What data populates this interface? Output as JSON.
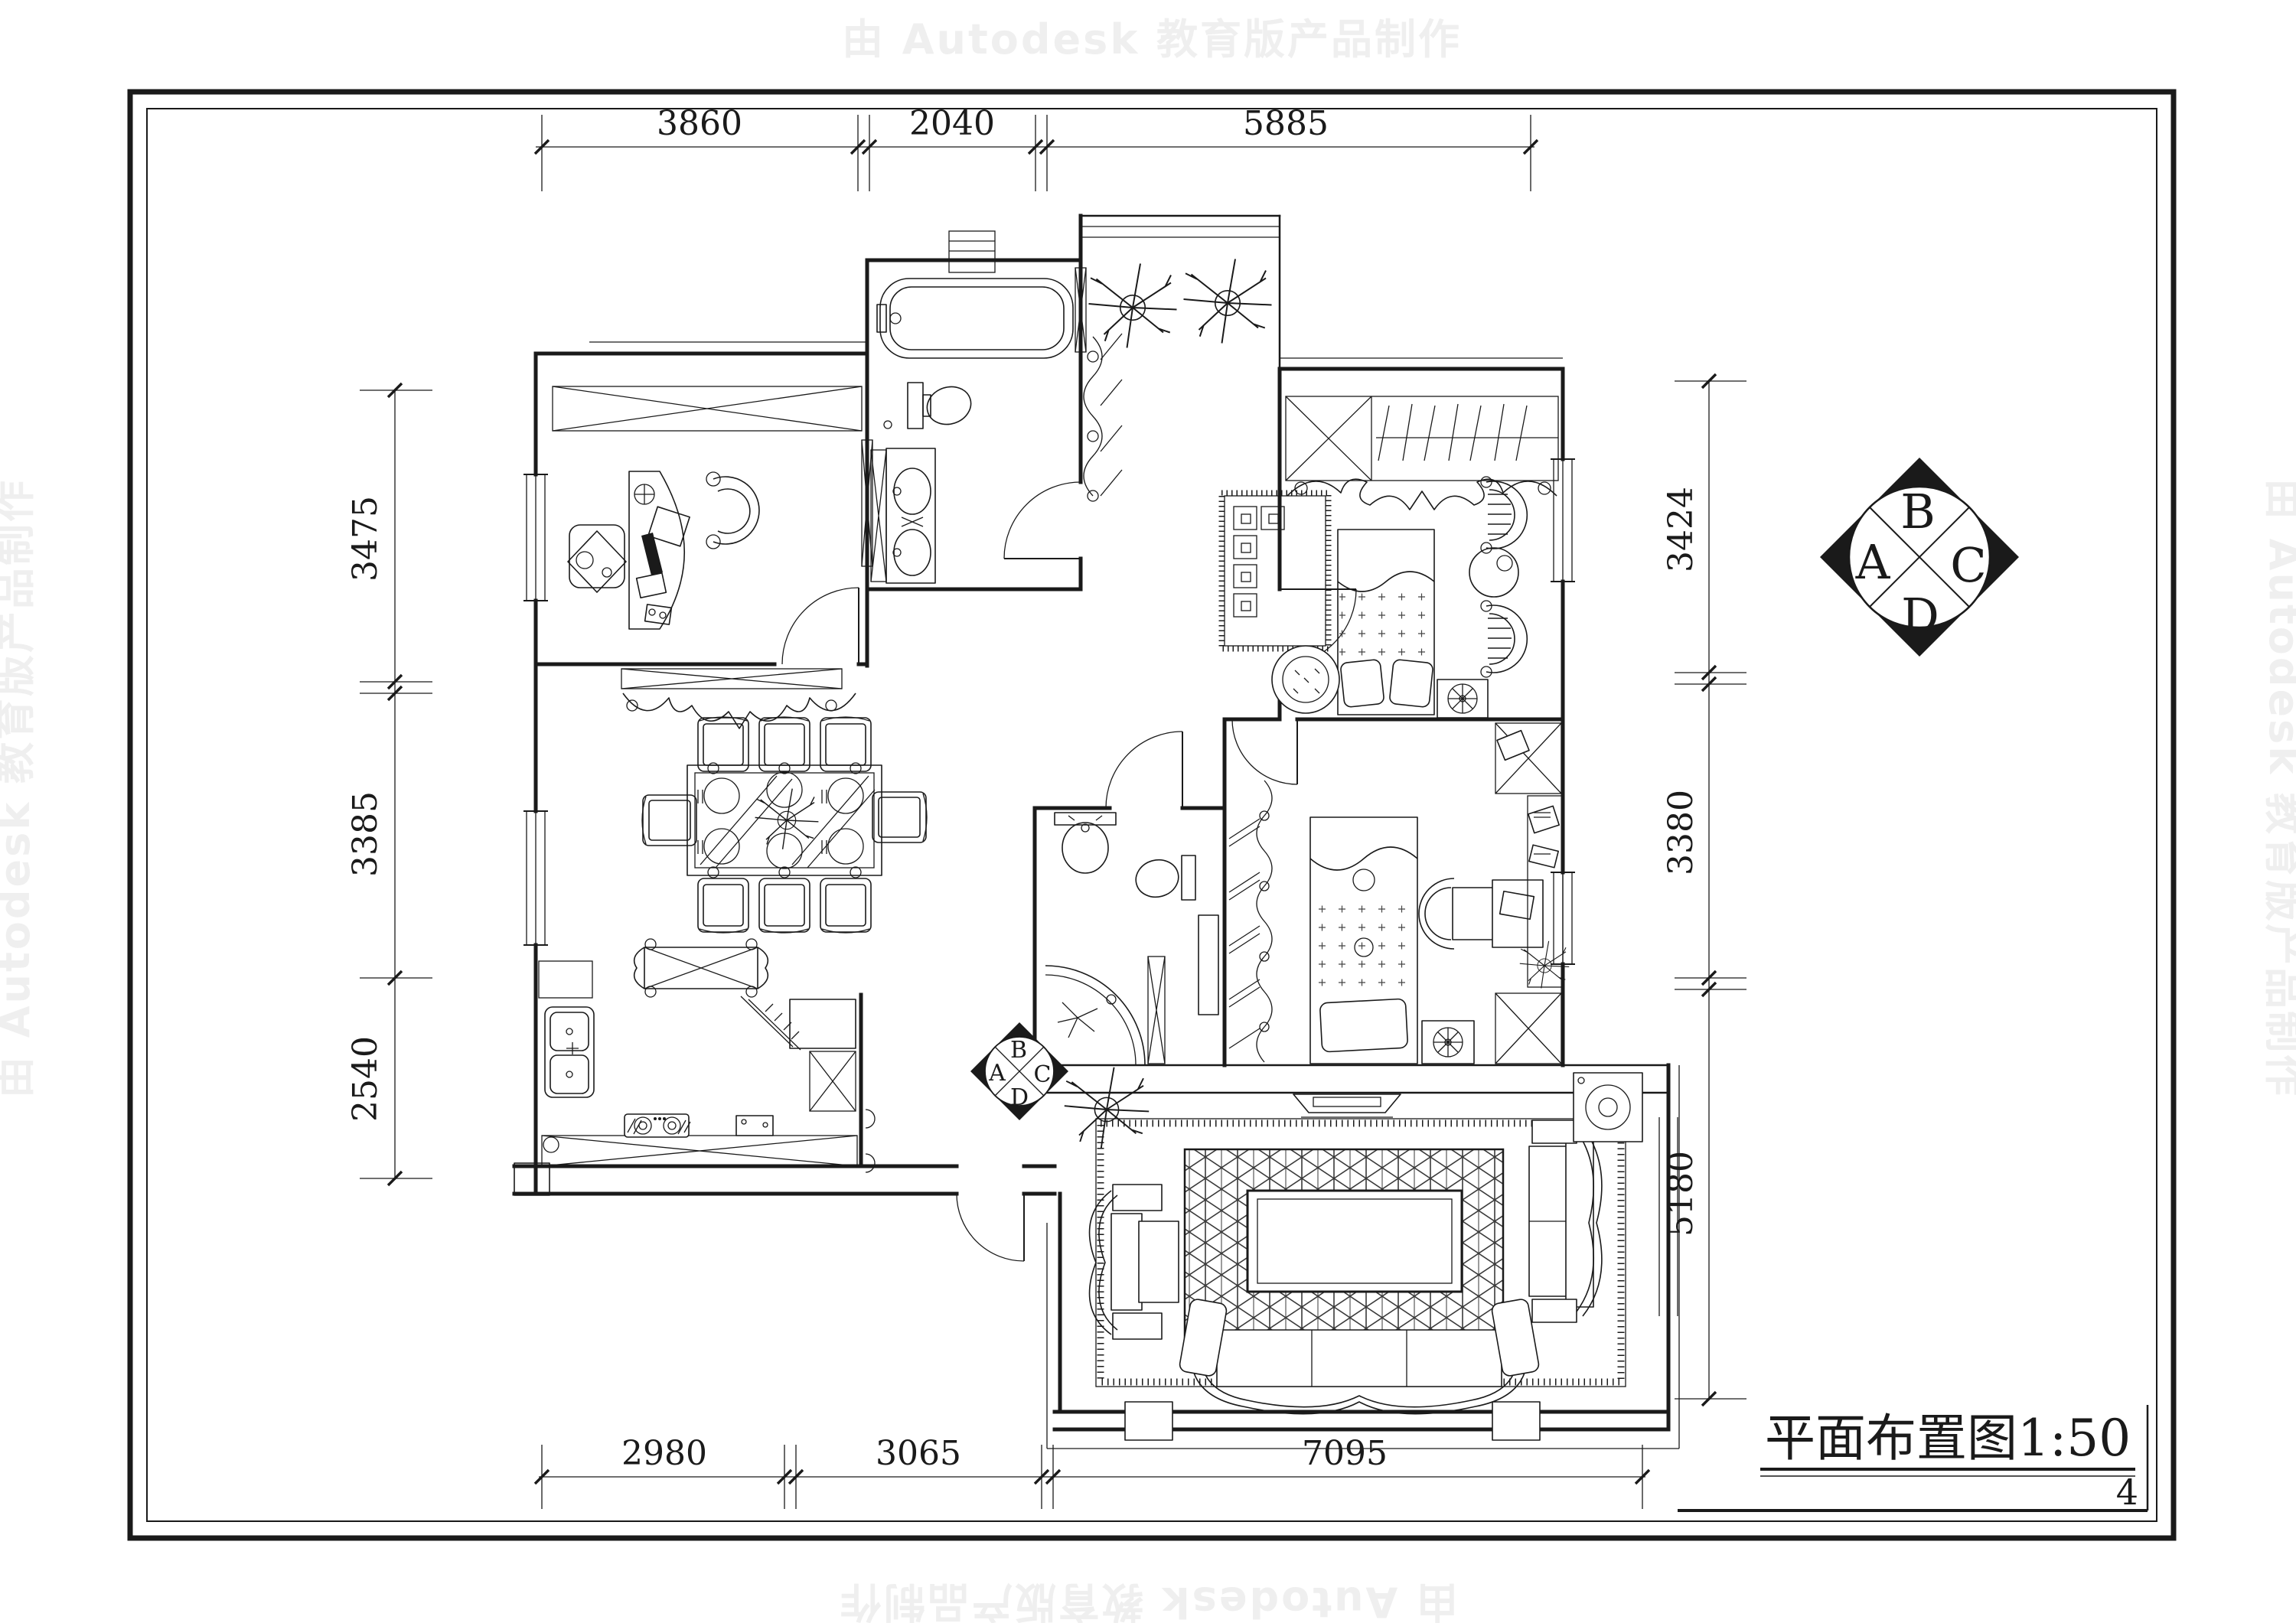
{
  "page": {
    "watermark_text": "由 Autodesk 教育版产品制作",
    "page_number": "4",
    "colors": {
      "line": "#1a1a1a",
      "paper": "#ffffff",
      "watermark": "#efefef"
    }
  },
  "title_block": {
    "title": "平面布置图1:50"
  },
  "dimensions": {
    "top": [
      "3860",
      "2040",
      "5885"
    ],
    "bottom": [
      "2980",
      "3065",
      "7095"
    ],
    "left": [
      "3475",
      "3385",
      "2540"
    ],
    "right": [
      "3424",
      "3380",
      "5180"
    ]
  },
  "orientation_marker": {
    "left": "A",
    "top": "B",
    "right": "C",
    "bottom": "D"
  }
}
